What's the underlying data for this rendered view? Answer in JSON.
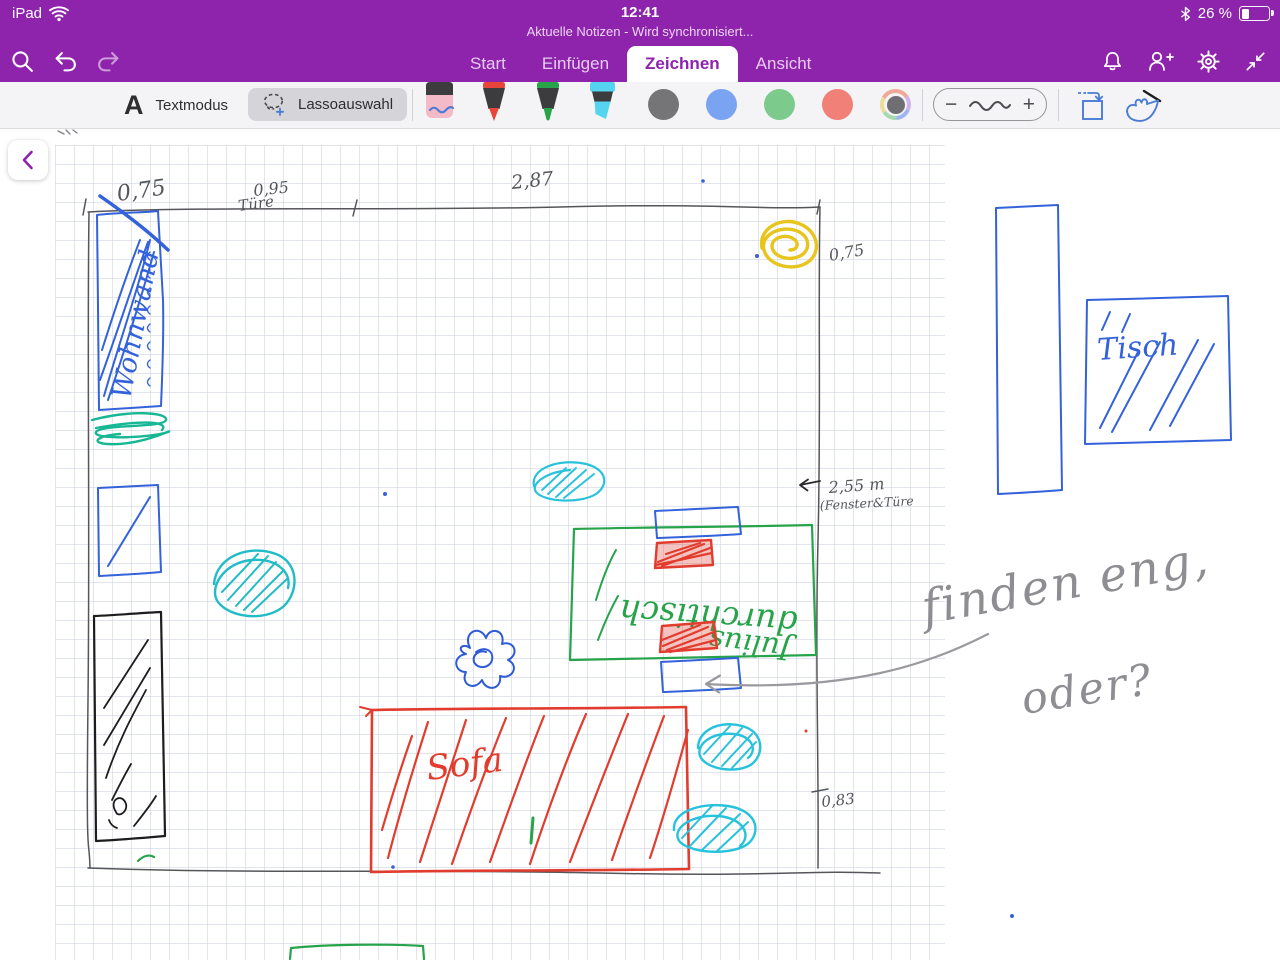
{
  "status_bar": {
    "device_label": "iPad",
    "time": "12:41",
    "battery_percent": "26 %"
  },
  "header": {
    "subtitle": "Aktuelle Notizen - Wird synchronisiert...",
    "tabs": [
      {
        "label": "Start",
        "active": false
      },
      {
        "label": "Einfügen",
        "active": false
      },
      {
        "label": "Zeichnen",
        "active": true
      },
      {
        "label": "Ansicht",
        "active": false
      }
    ]
  },
  "toolbar": {
    "text_icon_glyph": "A",
    "textmodus_label": "Textmodus",
    "lasso_label": "Lassoauswahl",
    "stroke_minus": "−",
    "stroke_plus": "+",
    "swatch_colors": {
      "gray": "#757578",
      "blue": "#7aa3f2",
      "green": "#7cca8c",
      "red": "#f08078"
    }
  },
  "canvas": {
    "ink_colors": {
      "blue": "#3462da",
      "green": "#27a34a",
      "red": "#e23c2e",
      "teal": "#17b795",
      "cyan": "#28c2dc",
      "yellow": "#e7c51c",
      "pencil": "#8e8e92",
      "wall_gray": "#55565a"
    },
    "measurements": {
      "top_left": "0,75",
      "door": "0,95",
      "door_label": "Türe",
      "top_width": "2,87",
      "right_top": "0,75",
      "right_mid": "2,55 m",
      "right_mid_note": "(Fenster&Türe",
      "right_bottom": "0,83"
    },
    "ink_labels": {
      "wohnwand": "Wohnwand",
      "tisch": "Tisch",
      "sofa": "Sofa",
      "table_text_1": "durchtisch",
      "table_text_2": "Julius"
    },
    "pencil_note_line1": "finden eng,",
    "pencil_note_line2": "oder?"
  }
}
